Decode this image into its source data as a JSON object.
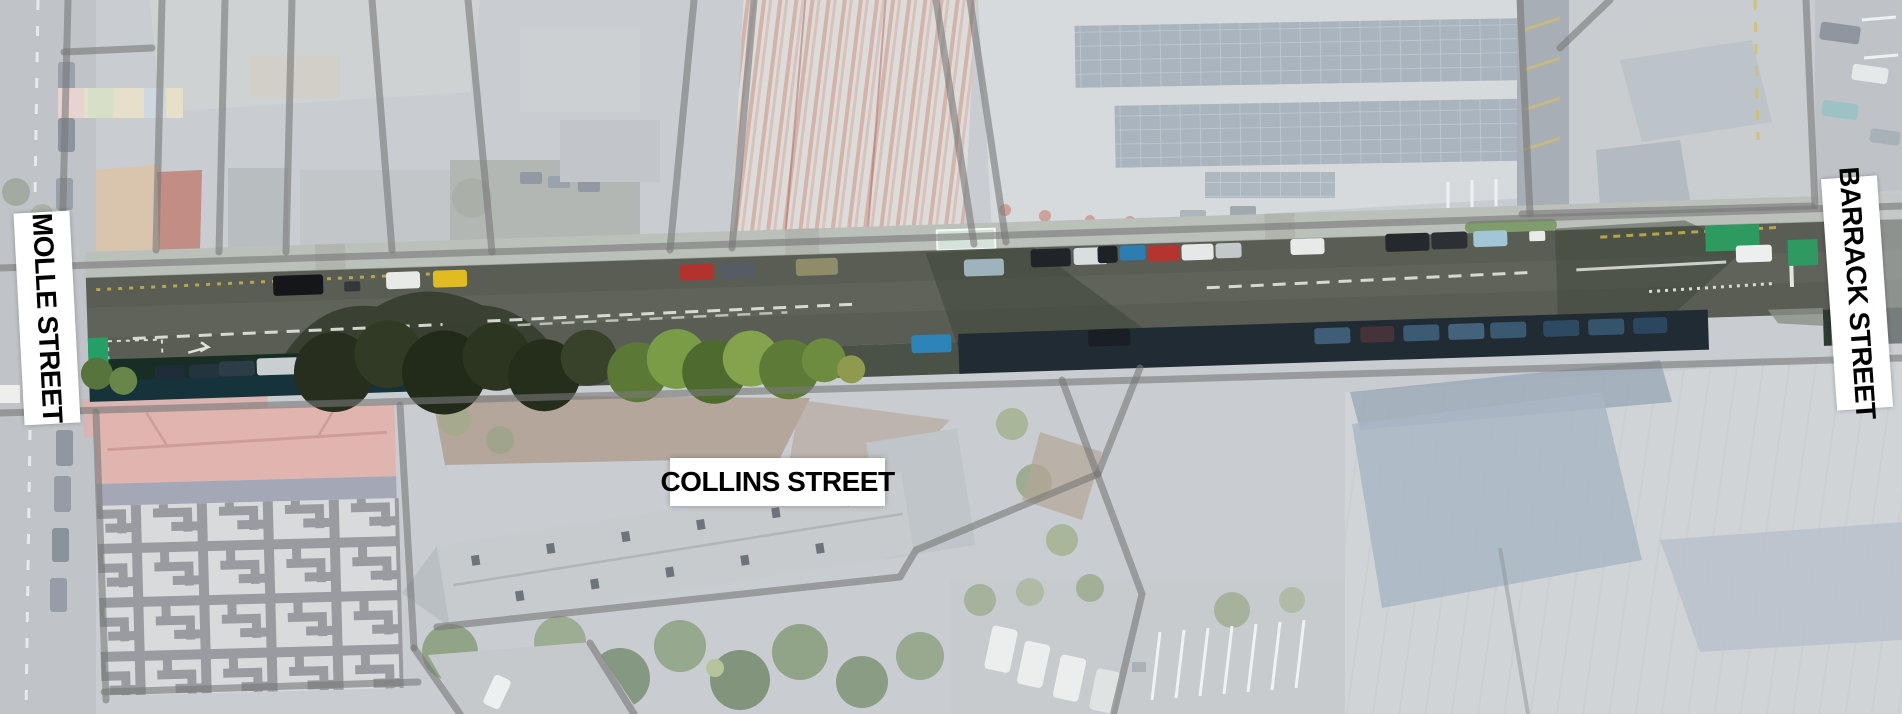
{
  "map": {
    "title": "Collins Street corridor aerial map",
    "labels": {
      "molle": "MOLLE STREET",
      "collins": "COLLINS STREET",
      "barrack": "BARRACK STREET"
    },
    "colors": {
      "label_background": "#ffffff",
      "label_text": "#000000",
      "washed_base": "#c9cdd1",
      "cadastre_gray": "#787878",
      "road_asphalt": "#595d53",
      "bike_lane_green": "#23a066",
      "shadow_navy": "#202b34"
    }
  }
}
